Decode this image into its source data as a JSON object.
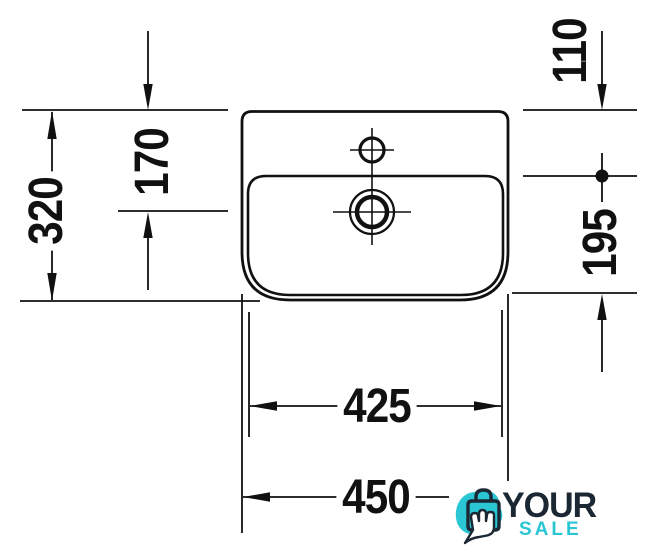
{
  "diagram": {
    "type": "technical-drawing",
    "subject": "washbasin top view with millimetre dimensions",
    "labels": {
      "left": "320",
      "inner_left": "170",
      "top_right": "110",
      "right": "195",
      "bottom_inner": "425",
      "bottom": "450"
    }
  },
  "logo": {
    "line1": "YOUR",
    "line2": "SALE"
  },
  "colors": {
    "line": "#111111",
    "background": "#ffffff",
    "logo_navy": "#1b2733",
    "logo_teal": "#2bc6d4"
  }
}
